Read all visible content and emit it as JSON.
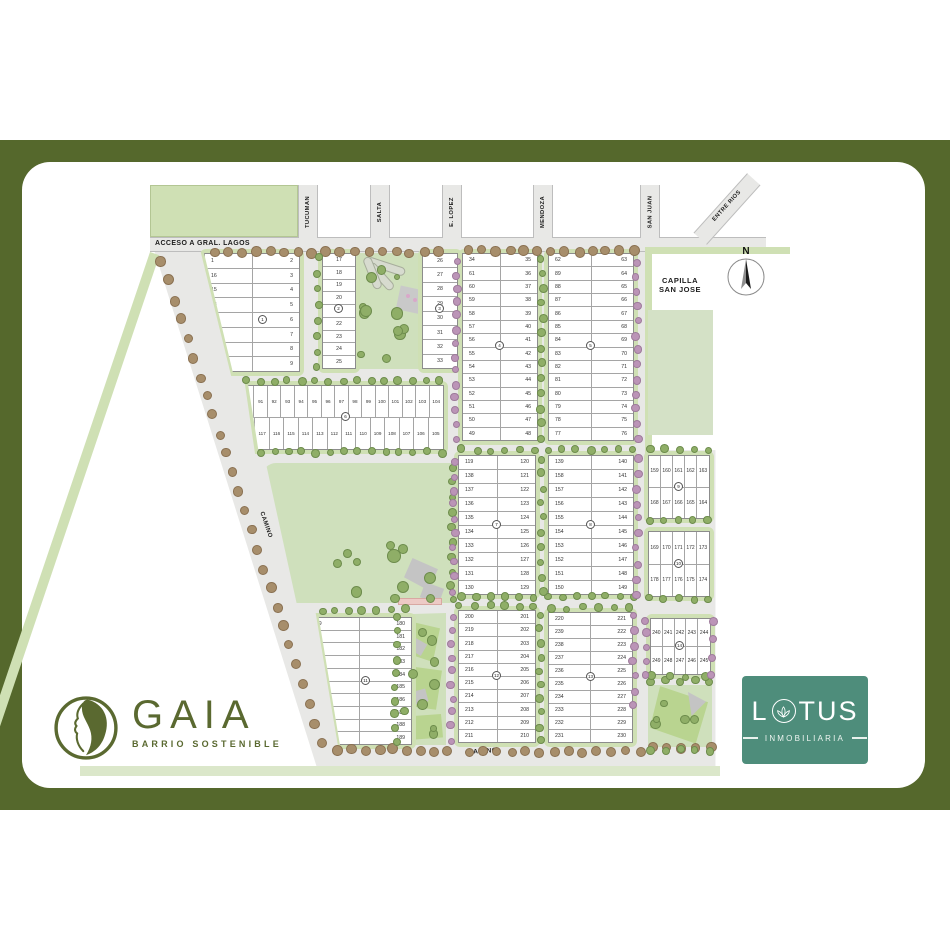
{
  "colors": {
    "frame_olive": "#55682c",
    "brand_green": "#5a6930",
    "brand_teal": "#4e8d7b",
    "park_green": "#cfe0b4",
    "road_gray": "#e8e8e6",
    "tree_green": "#8fae67",
    "tree_brown": "#a78e6b",
    "tree_purple": "#bb94b7",
    "accent_pink": "#edcac5"
  },
  "logos": {
    "gaia": {
      "name": "GAIA",
      "tagline": "BARRIO SOSTENIBLE"
    },
    "lotus": {
      "p1": "L",
      "p2": "TUS",
      "tagline": "INMOBILIARIA"
    }
  },
  "map": {
    "streets": {
      "acceso": "ACCESO A GRAL. LAGOS",
      "tucuman": "TUCUMAN",
      "salta": "SALTA",
      "lopez": "E. LOPEZ",
      "mendoza": "MENDOZA",
      "sanjuan": "SAN JUAN",
      "entrerios": "ENTRE RIOS",
      "camino_left": "CAMINO",
      "camino_bottom": "CAMINO"
    },
    "capilla": {
      "line1": "CAPILLA",
      "line2": "SAN JOSE"
    },
    "compass_n": "N",
    "blocks": [
      {
        "id": "b1",
        "badge": "1",
        "groups": [
          [
            1,
            16,
            15,
            14,
            13,
            12,
            11,
            10
          ],
          [
            2,
            3,
            4,
            5,
            6,
            7,
            8,
            9
          ]
        ]
      },
      {
        "id": "b2l",
        "badge": "2",
        "groups": [
          [
            17,
            18,
            19,
            20,
            21,
            22,
            23,
            24,
            25
          ]
        ]
      },
      {
        "id": "b2r",
        "badge": "3",
        "groups": [
          [
            26,
            27,
            28,
            29,
            30,
            31,
            32,
            33
          ]
        ]
      },
      {
        "id": "b3",
        "badge": "4",
        "groups": [
          [
            34,
            61,
            60,
            59,
            58,
            57,
            56,
            55,
            54,
            53,
            52,
            51,
            50,
            49
          ],
          [
            35,
            36,
            37,
            38,
            39,
            40,
            41,
            42,
            43,
            44,
            45,
            46,
            47,
            48
          ]
        ]
      },
      {
        "id": "b4",
        "badge": "5",
        "groups": [
          [
            62,
            89,
            88,
            87,
            86,
            85,
            84,
            83,
            82,
            81,
            80,
            79,
            78,
            77
          ],
          [
            63,
            64,
            65,
            66,
            67,
            68,
            69,
            70,
            71,
            72,
            73,
            74,
            75,
            76
          ]
        ]
      },
      {
        "id": "b5",
        "badge": "6",
        "groups": [
          [
            90,
            91,
            92,
            93,
            94,
            95,
            96,
            97,
            98,
            99,
            100,
            101,
            102,
            103,
            104
          ],
          [
            118,
            117,
            116,
            115,
            114,
            113,
            112,
            111,
            110,
            109,
            108,
            107,
            106,
            105
          ]
        ]
      },
      {
        "id": "b6",
        "badge": "7",
        "groups": [
          [
            119,
            138,
            137,
            136,
            135,
            134,
            133,
            132,
            131,
            130
          ],
          [
            120,
            121,
            122,
            123,
            124,
            125,
            126,
            127,
            128,
            129
          ]
        ]
      },
      {
        "id": "b7",
        "badge": "8",
        "groups": [
          [
            139,
            158,
            157,
            156,
            155,
            154,
            153,
            152,
            151,
            150
          ],
          [
            140,
            141,
            142,
            143,
            144,
            145,
            146,
            147,
            148,
            149
          ]
        ]
      },
      {
        "id": "b8",
        "badge": "9",
        "groups": [
          [
            159,
            160,
            161,
            162,
            163
          ],
          [
            168,
            167,
            166,
            165,
            164
          ]
        ]
      },
      {
        "id": "b9",
        "badge": "10",
        "groups": [
          [
            169,
            170,
            171,
            172,
            173
          ],
          [
            178,
            177,
            176,
            175,
            174
          ]
        ]
      },
      {
        "id": "b10",
        "badge": "11",
        "groups": [
          [
            179,
            198,
            197,
            196,
            195,
            194,
            193,
            192,
            191,
            190
          ],
          [
            180,
            181,
            182,
            183,
            184,
            185,
            186,
            187,
            188,
            189
          ]
        ]
      },
      {
        "id": "b11",
        "badge": "12",
        "groups": [
          [
            200,
            219,
            218,
            217,
            216,
            215,
            214,
            213,
            212,
            211
          ],
          [
            201,
            202,
            203,
            204,
            205,
            206,
            207,
            208,
            209,
            210
          ]
        ]
      },
      {
        "id": "b12",
        "badge": "13",
        "groups": [
          [
            220,
            239,
            238,
            237,
            236,
            235,
            234,
            233,
            232,
            231
          ],
          [
            221,
            222,
            223,
            224,
            225,
            226,
            227,
            228,
            229,
            230
          ]
        ]
      },
      {
        "id": "b13",
        "badge": "14",
        "groups": [
          [
            240,
            241,
            242,
            243,
            244
          ],
          [
            249,
            248,
            247,
            246,
            245
          ]
        ]
      }
    ]
  }
}
